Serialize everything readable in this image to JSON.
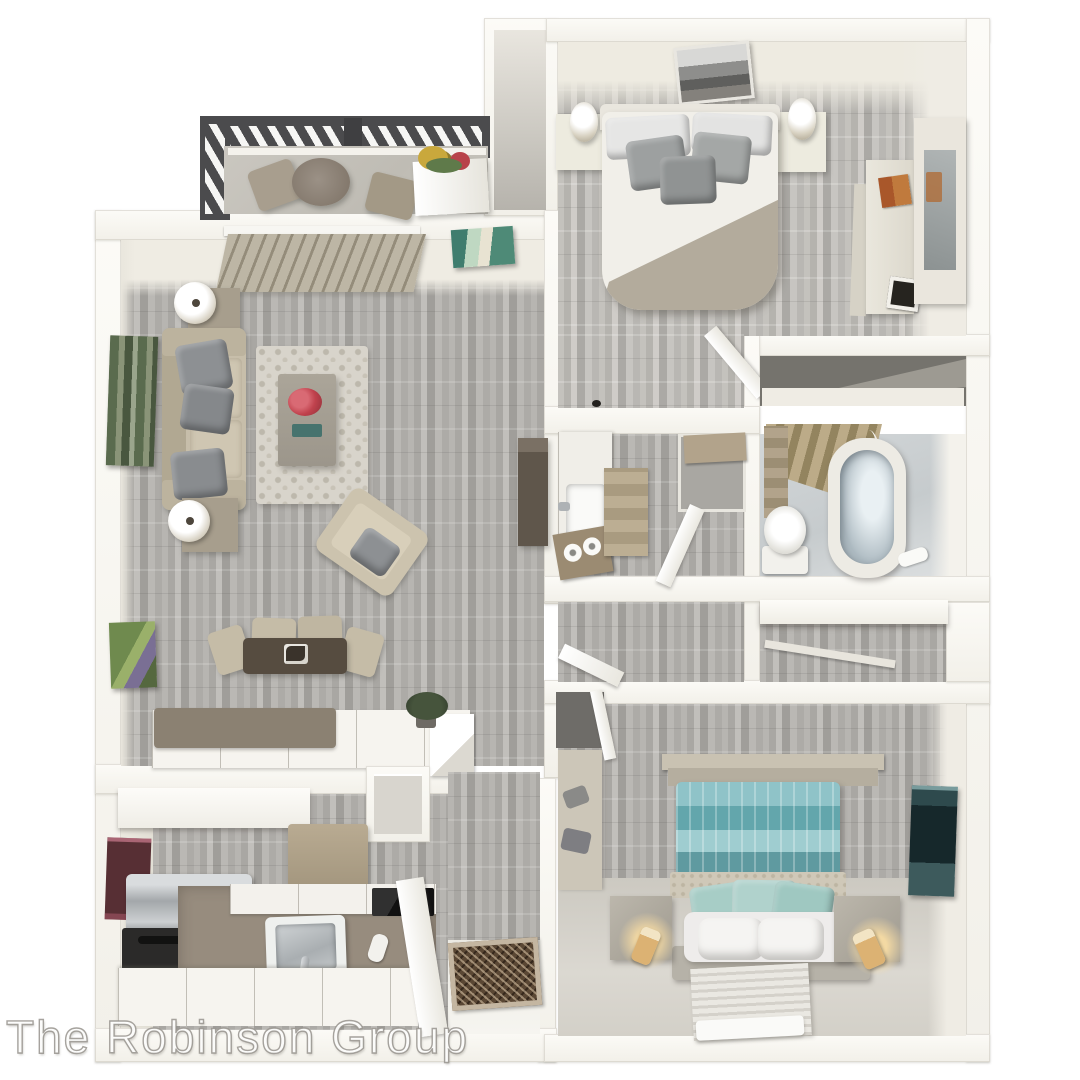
{
  "watermark": {
    "text": "The Robinson Group"
  },
  "palette": {
    "wall": "#f2f0e9",
    "wall_bright": "#fcfbf7",
    "wall_face": "#e8e5db",
    "plank_mid": "#b2b0ac",
    "balcony_floor": "#c6c3bb",
    "railing": "#4b4b4d",
    "blinds": "#b3ac9c",
    "sofa_beige": "#c7beaa",
    "pillow_grey": "#8d9093",
    "rug_light": "#d8d4cb",
    "dining_wood": "#564c40",
    "chair_beige": "#c5bca7",
    "counter_taupe": "#978c7e",
    "bar_taupe": "#8b8172",
    "cabinet_white": "#f6f4ef",
    "range_black": "#2b2a29",
    "steel": "#b9bec1",
    "entry_mat": "#5a4734",
    "bed_white": "#f1efe9",
    "blanket_tan": "#b3ab9c",
    "teal_duvet": "#79b4ba",
    "seafoam_pillow": "#a7cdc6",
    "concrete_stand": "#b3aea3",
    "lamp_glow": "#f2cf92",
    "tub_inner": "#aebbc2",
    "bath_tile": "#ced3d5",
    "art_forest": "#5a6b4e",
    "art_maroon": "#572f34",
    "art_teal_dark": "#16282b"
  }
}
